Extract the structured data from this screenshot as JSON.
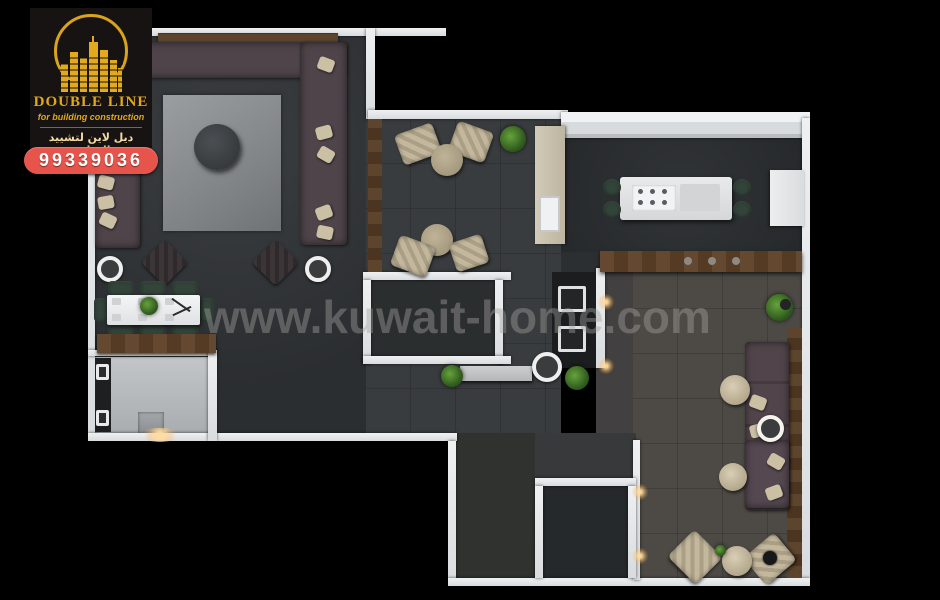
{
  "branding": {
    "logo": {
      "icon": "skyline-buildings-icon",
      "company_name": "DOUBLE LINE",
      "tagline": "for building construction",
      "arabic_name": "ديل لاين لتشييد المبانى"
    },
    "phone_badge": "99339036"
  },
  "watermark": "www.kuwait-home.com",
  "palette": {
    "background": "#000000",
    "wall_white": "#E6E8EA",
    "floor_dark_gray": "#323537",
    "floor_warm_gray": "#4B4845",
    "bathroom_floor_light": "#B8BCBE",
    "wood_brown": "#5A4129",
    "sofa_dark_mauve": "#4E4449",
    "beige_fabric": "#C4B89E",
    "rug_gray": "#8F9396",
    "green_chair": "#33453B",
    "plant_green": "#3E6B2A",
    "logo_gold": "#E2A81C",
    "badge_red": "#E6544B"
  },
  "floorplan": {
    "description": "3D top-down render of an apartment interior",
    "rooms": [
      {
        "name": "majlis-living-room",
        "furniture": [
          "tv-console",
          "u-shaped-sectional-sofa",
          "area-rug",
          "round-ottoman",
          "accent-chairs",
          "round-side-tables"
        ]
      },
      {
        "name": "dining-area",
        "furniture": [
          "eight-seat-dining-table",
          "wood-sideboard"
        ]
      },
      {
        "name": "bathroom",
        "furniture": [
          "double-basin-vanity",
          "shower-unit"
        ]
      },
      {
        "name": "tea-sitting-area",
        "furniture": [
          "armchair-pair-with-round-table",
          "second-armchair-pair-with-round-table",
          "planter",
          "stone-counter-with-sink",
          "wood-panel"
        ]
      },
      {
        "name": "kitchen",
        "furniture": [
          "white-island-with-cooktop",
          "four-bar-stools",
          "wood-counter",
          "tall-white-unit"
        ]
      },
      {
        "name": "utility-corridor",
        "furniture": [
          "built-in-appliance-column",
          "console-table",
          "round-side-table",
          "plants",
          "wall-sconces"
        ]
      },
      {
        "name": "family-living-room",
        "furniture": [
          "wall-length-sofa",
          "round-poufs",
          "two-angled-armchairs",
          "round-pouf-table",
          "corner-plant",
          "wood-ledge"
        ]
      },
      {
        "name": "empty-room-a",
        "furniture": []
      },
      {
        "name": "empty-room-b",
        "furniture": []
      }
    ]
  }
}
